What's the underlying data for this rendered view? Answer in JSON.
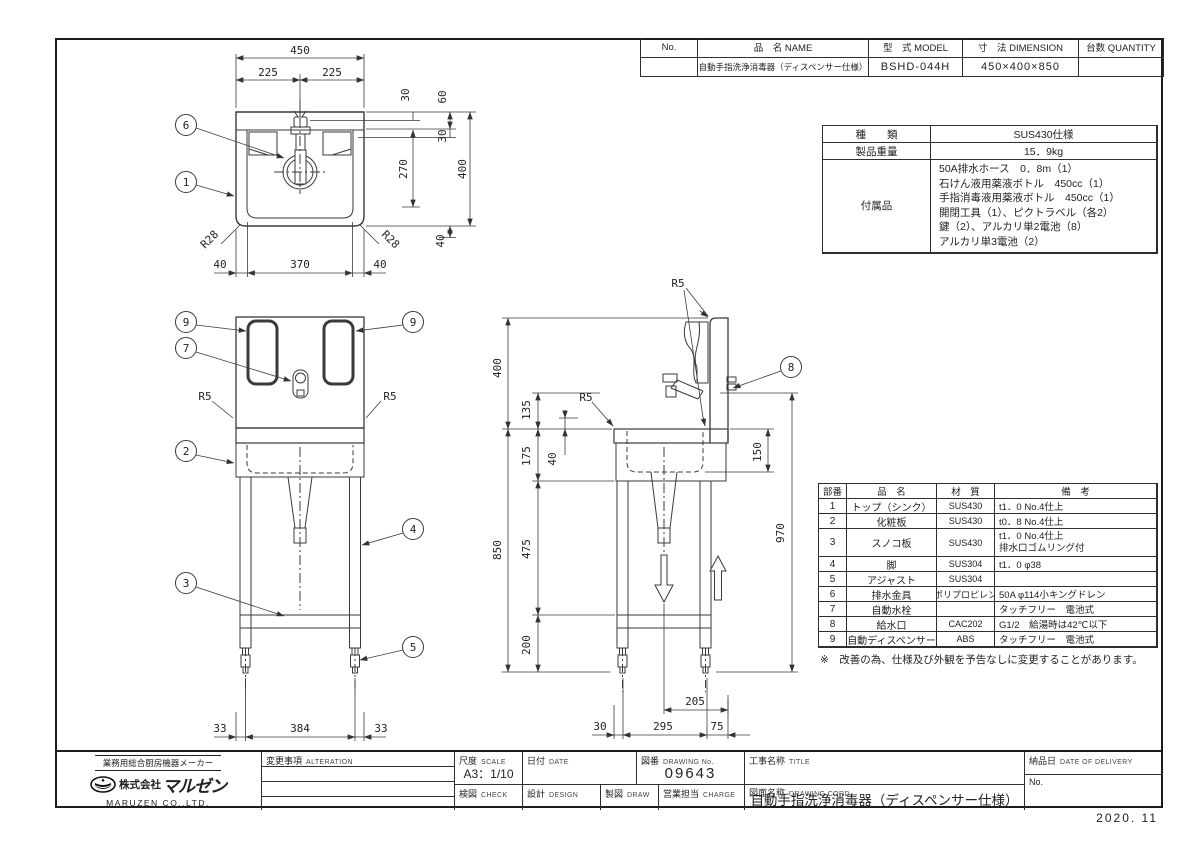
{
  "stamp": "2020. 11",
  "header_table": {
    "no_label": "No.",
    "name_label": "品　名 NAME",
    "model_label": "型　式 MODEL",
    "dim_label": "寸　法 DIMENSION",
    "qty_label": "台数 QUANTITY",
    "no_value": "",
    "name_value": "自動手指洗浄消毒器（ディスペンサー仕様）",
    "model_value": "BSHD-044H",
    "dim_value": "450×400×850",
    "qty_value": ""
  },
  "spec_table": {
    "kind_label": "種　　類",
    "kind_value": "SUS430仕様",
    "weight_label": "製品重量",
    "weight_value": "15．9kg",
    "acc_label": "付属品",
    "acc_lines": [
      "50A排水ホース　0．8m（1）",
      "石けん液用薬液ボトル　450cc（1）",
      "手指消毒液用薬液ボトル　450cc（1）",
      "開閉工具（1）、ピクトラベル（各2）",
      "鍵（2）、アルカリ単2電池（8）",
      "アルカリ単3電池（2）"
    ]
  },
  "parts_table": {
    "headers": {
      "no": "部番",
      "name": "品　名",
      "material": "材　質",
      "remark": "備　考"
    },
    "rows": [
      {
        "no": "1",
        "name": "トップ（シンク）",
        "material": "SUS430",
        "remark": "t1．0 No.4仕上"
      },
      {
        "no": "2",
        "name": "化粧板",
        "material": "SUS430",
        "remark": "t0．8 No.4仕上"
      },
      {
        "no": "3",
        "name": "スノコ板",
        "material": "SUS430",
        "remark": "t1．0 No.4仕上\n排水口ゴムリング付"
      },
      {
        "no": "4",
        "name": "脚",
        "material": "SUS304",
        "remark": "t1．0 φ38"
      },
      {
        "no": "5",
        "name": "アジャスト",
        "material": "SUS304",
        "remark": ""
      },
      {
        "no": "6",
        "name": "排水金具",
        "material": "ポリプロピレン",
        "remark": "50A φ114小キングドレン"
      },
      {
        "no": "7",
        "name": "自動水栓",
        "material": "",
        "remark": "タッチフリー　電池式"
      },
      {
        "no": "8",
        "name": "給水口",
        "material": "CAC202",
        "remark": "G1/2　給湯時は42℃以下"
      },
      {
        "no": "9",
        "name": "自動ディスペンサー",
        "material": "ABS",
        "remark": "タッチフリー　電池式"
      }
    ],
    "note": "※　改善の為、仕様及び外観を予告なしに変更することがあります。"
  },
  "title_block": {
    "alteration_label": "変更事項",
    "alteration_en": "ALTERATION",
    "scale_label": "尺度",
    "scale_en": "SCALE",
    "scale_value": "A3：1/10",
    "date_label": "日付",
    "date_en": "DATE",
    "date_value": "",
    "drawing_no_label": "図番",
    "drawing_no_en": "DRAWING No.",
    "drawing_no_value": "09643",
    "title_label": "工事名称",
    "title_en": "TITLE",
    "title_value": "",
    "check_label": "検図",
    "check_en": "CHECK",
    "design_label": "設計",
    "design_en": "DESIGN",
    "draw_label": "製図",
    "draw_en": "DRAW",
    "charge_label": "営業担当",
    "charge_en": "CHARGE",
    "name_label": "図面名称",
    "name_en": "DRAWING CORD",
    "name_value": "自動手指洗浄消毒器（ディスペンサー仕様）",
    "delivery_label": "納品日",
    "delivery_en": "DATE OF DELIVERY",
    "delivery_value": "",
    "no_label": "No.",
    "no_value": ""
  },
  "company": {
    "industry_line": "業務用総合厨房機器メーカー",
    "name_prefix": "株式会社",
    "name_logo": "マルゼン",
    "name_en": "MARUZEN  CO.,LTD."
  },
  "plan": {
    "balloon_6": "6",
    "balloon_1": "1",
    "dim_450": "450",
    "dim_225l": "225",
    "dim_225r": "225",
    "dim_30a": "30",
    "dim_60": "60",
    "dim_30b": "30",
    "dim_270": "270",
    "dim_400": "400",
    "dim_40r": "40",
    "r28_left": "R28",
    "r28_right": "R28",
    "dim_40l": "40",
    "dim_370": "370",
    "dim_40b": "40"
  },
  "front": {
    "balloon_9l": "9",
    "balloon_9r": "9",
    "balloon_7": "7",
    "balloon_2": "2",
    "balloon_4": "4",
    "balloon_3": "3",
    "balloon_5": "5",
    "r5_left": "R5",
    "r5_right": "R5",
    "dim_33l": "33",
    "dim_384": "384",
    "dim_33r": "33"
  },
  "side": {
    "balloon_8": "8",
    "r5_top": "R5",
    "r5_left": "R5",
    "dim_400": "400",
    "dim_135": "135",
    "dim_175": "175",
    "dim_40": "40",
    "dim_850": "850",
    "dim_475": "475",
    "dim_200": "200",
    "dim_150": "150",
    "dim_970": "970",
    "dim_205": "205",
    "dim_30": "30",
    "dim_295": "295",
    "dim_75": "75"
  }
}
